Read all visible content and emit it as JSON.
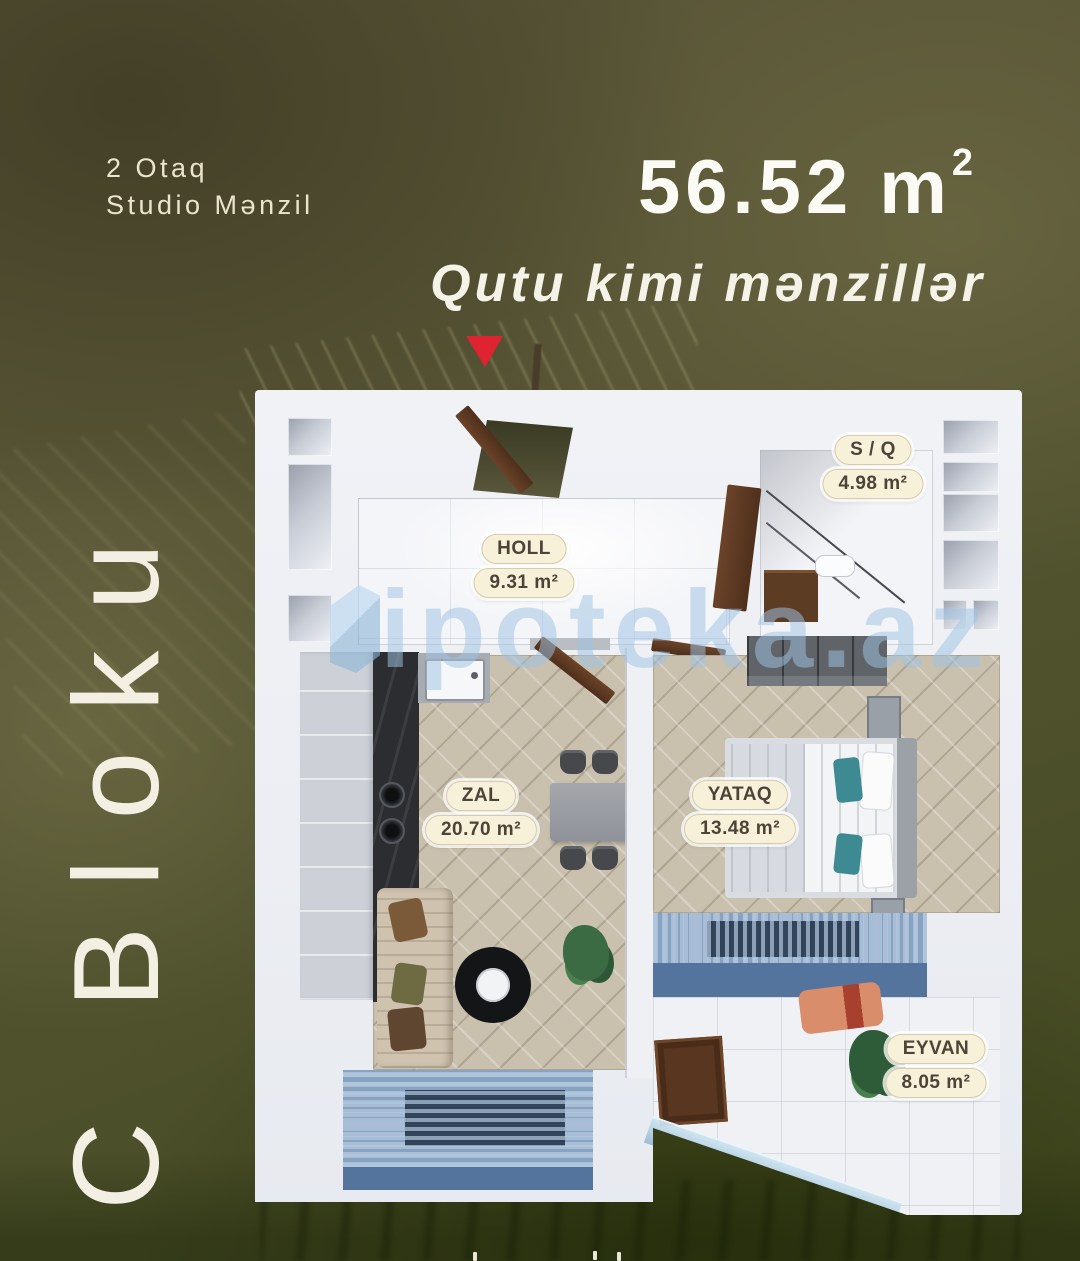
{
  "poster": {
    "type_line1": "2 Otaq",
    "type_line2": "Studio Mənzil",
    "total_area_value": "56.52 m",
    "total_area_sup": "2",
    "tagline": "Qutu kimi mənzillər",
    "block_label": "C Bloku"
  },
  "watermark": {
    "text": "ipoteka.az"
  },
  "floorplan": {
    "rooms": [
      {
        "name": "HOLL",
        "area": "9.31 m²"
      },
      {
        "name": "S / Q",
        "area": "4.98 m²"
      },
      {
        "name": "ZAL",
        "area": "20.70 m²"
      },
      {
        "name": "YATAQ",
        "area": "13.48 m²"
      },
      {
        "name": "EYVAN",
        "area": "8.05 m²"
      }
    ]
  },
  "colors": {
    "accent_red": "#df2330",
    "badge_background": "#f8f1da",
    "badge_text": "#4d4337",
    "watermark_blue": "#9fc4e4",
    "background_olive": "#55523a",
    "window_blue": "#54749e"
  }
}
